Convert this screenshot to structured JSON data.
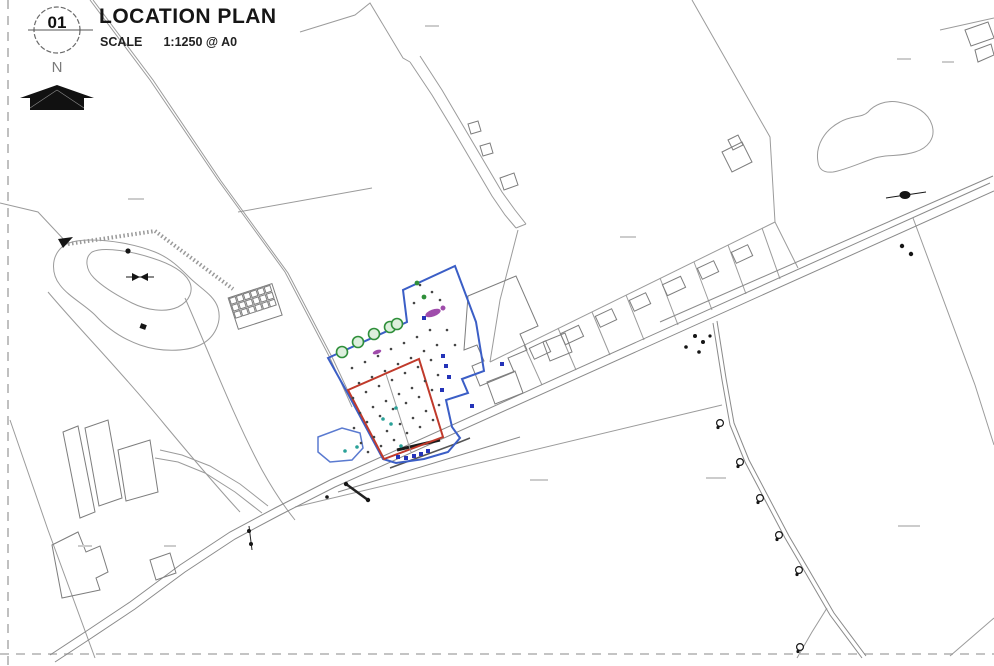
{
  "title_block": {
    "detail_number": "01",
    "title": "LOCATION PLAN",
    "scale_label": "SCALE",
    "scale_value": "1:1250 @ A0",
    "north_label": "N"
  },
  "map_features": {
    "site_boundary_color": "#3b5ec6",
    "plot_boundary_color": "#c03a2b",
    "tree_color": "#2f8f3a",
    "trees": [
      [
        342,
        352
      ],
      [
        358,
        342
      ],
      [
        374,
        334
      ],
      [
        390,
        327
      ],
      [
        397,
        324
      ]
    ],
    "utility_poles": [
      [
        720,
        423
      ],
      [
        740,
        462
      ],
      [
        760,
        498
      ],
      [
        779,
        535
      ],
      [
        799,
        570
      ],
      [
        800,
        647
      ]
    ],
    "green_markers": [
      [
        417,
        283
      ],
      [
        424,
        297
      ]
    ],
    "teal_markers": [
      [
        383,
        419
      ],
      [
        391,
        424
      ],
      [
        357,
        447
      ],
      [
        401,
        446
      ],
      [
        345,
        451
      ],
      [
        396,
        408
      ]
    ],
    "magenta_markers": [
      [
        433,
        313,
        16,
        7
      ],
      [
        377,
        352,
        9,
        4
      ],
      [
        443,
        308,
        5,
        5
      ]
    ],
    "blue_markers": [
      [
        398,
        457
      ],
      [
        406,
        458
      ],
      [
        414,
        456
      ],
      [
        421,
        454
      ],
      [
        428,
        451
      ],
      [
        472,
        406
      ],
      [
        502,
        364
      ],
      [
        443,
        356
      ],
      [
        446,
        366
      ],
      [
        449,
        377
      ],
      [
        442,
        390
      ],
      [
        424,
        318
      ]
    ],
    "survey_points": [
      [
        352,
        368
      ],
      [
        365,
        362
      ],
      [
        378,
        356
      ],
      [
        391,
        349
      ],
      [
        404,
        343
      ],
      [
        417,
        337
      ],
      [
        430,
        330
      ],
      [
        359,
        383
      ],
      [
        372,
        377
      ],
      [
        385,
        371
      ],
      [
        398,
        364
      ],
      [
        411,
        358
      ],
      [
        424,
        351
      ],
      [
        437,
        345
      ],
      [
        353,
        398
      ],
      [
        366,
        392
      ],
      [
        379,
        386
      ],
      [
        392,
        380
      ],
      [
        405,
        373
      ],
      [
        418,
        367
      ],
      [
        431,
        360
      ],
      [
        360,
        413
      ],
      [
        373,
        407
      ],
      [
        386,
        401
      ],
      [
        399,
        394
      ],
      [
        412,
        388
      ],
      [
        425,
        381
      ],
      [
        438,
        375
      ],
      [
        354,
        428
      ],
      [
        367,
        422
      ],
      [
        380,
        416
      ],
      [
        393,
        409
      ],
      [
        406,
        403
      ],
      [
        419,
        397
      ],
      [
        432,
        390
      ],
      [
        361,
        443
      ],
      [
        374,
        437
      ],
      [
        387,
        431
      ],
      [
        400,
        424
      ],
      [
        413,
        418
      ],
      [
        426,
        411
      ],
      [
        439,
        405
      ],
      [
        368,
        452
      ],
      [
        381,
        446
      ],
      [
        394,
        440
      ],
      [
        407,
        433
      ],
      [
        420,
        427
      ],
      [
        433,
        420
      ],
      [
        420,
        285
      ],
      [
        432,
        292
      ],
      [
        440,
        300
      ],
      [
        414,
        303
      ],
      [
        447,
        330
      ],
      [
        455,
        345
      ]
    ]
  }
}
